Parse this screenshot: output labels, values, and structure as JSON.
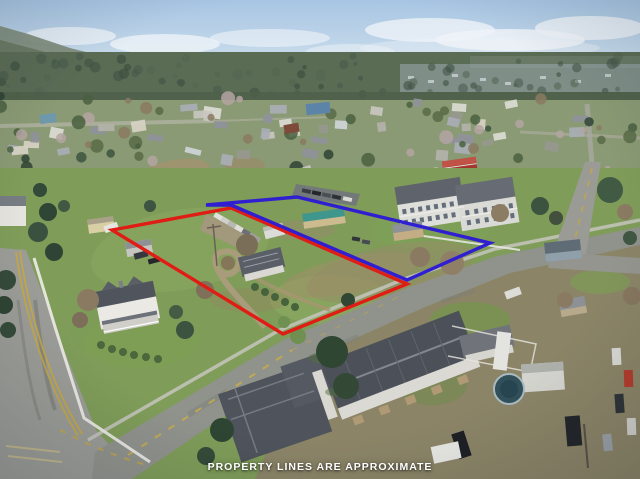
{
  "overlay": {
    "disclaimer": "PROPERTY LINES ARE APPROXIMATE",
    "disclaimer_color": "#ffffff"
  },
  "property_outlines": {
    "red": {
      "color": "#e01d15",
      "points": [
        [
          112,
          230
        ],
        [
          231,
          208
        ],
        [
          407,
          284
        ],
        [
          283,
          334
        ]
      ]
    },
    "blue": {
      "color": "#2f1fd0",
      "points": [
        [
          206,
          205
        ],
        [
          297,
          197
        ],
        [
          490,
          243
        ],
        [
          407,
          280
        ],
        [
          231,
          205
        ]
      ]
    }
  },
  "palette": {
    "sky": "#aec9e5",
    "distant_forest": "#55684f",
    "grass": "#7f9c59",
    "road": "#90928c",
    "dark_roof": "#4e525a",
    "barn_red": "#a3362c"
  }
}
